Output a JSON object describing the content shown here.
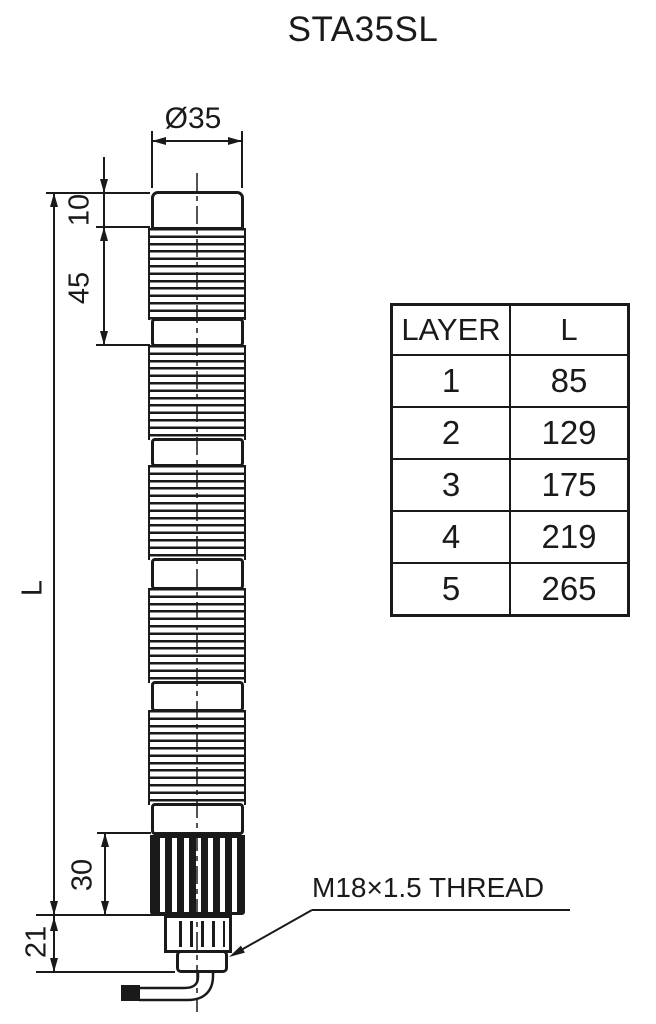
{
  "title": "STA35SL",
  "drawing": {
    "dimensions": {
      "diameter": "Ø35",
      "cap_height": "10",
      "layer_height": "45",
      "total_length": "L",
      "base_height": "30",
      "thread_length": "21"
    },
    "thread_label": "M18×1.5 THREAD",
    "layer_count": 5
  },
  "table": {
    "headers": [
      "LAYER",
      "L"
    ],
    "rows": [
      {
        "layer": "1",
        "l": "85"
      },
      {
        "layer": "2",
        "l": "129"
      },
      {
        "layer": "3",
        "l": "175"
      },
      {
        "layer": "4",
        "l": "219"
      },
      {
        "layer": "5",
        "l": "265"
      }
    ]
  },
  "colors": {
    "line": "#1a1a1a",
    "background": "#ffffff"
  }
}
